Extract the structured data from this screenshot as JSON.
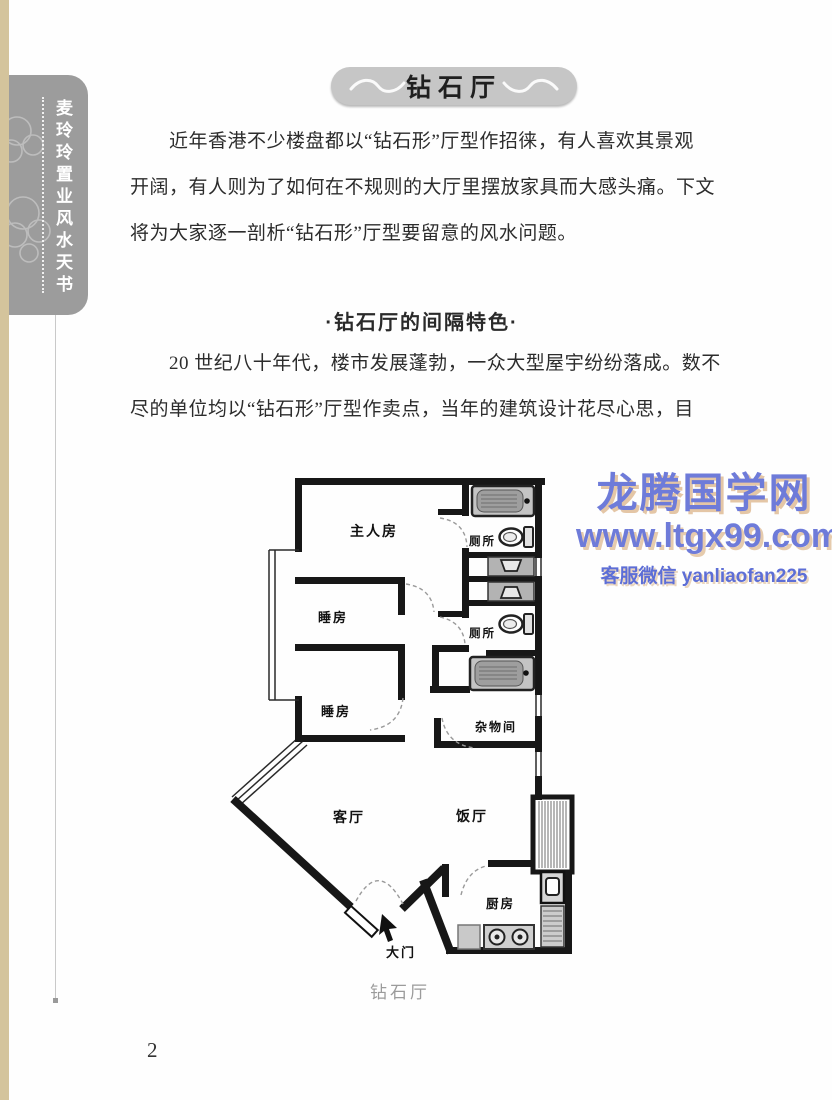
{
  "sidebar": {
    "book_title": "麦玲玲置业风水天书"
  },
  "title_banner": {
    "text": "钻石厅"
  },
  "article": {
    "para1_lines": [
      "近年香港不少楼盘都以“钻石形”厅型作招徕，有人喜欢其景观",
      "开阔，有人则为了如何在不规则的大厅里摆放家具而大感头痛。下文",
      "将为大家逐一剖析“钻石形”厅型要留意的风水问题。"
    ],
    "section_heading": "·钻石厅的间隔特色·",
    "para2_lines": [
      "20 世纪八十年代，楼市发展蓬勃，一众大型屋宇纷纷落成。数不",
      "尽的单位均以“钻石形”厅型作卖点，当年的建筑设计花尽心思，目"
    ]
  },
  "watermark": {
    "site_name": "龙腾国学网",
    "url": "www.ltgx99.com",
    "contact": "客服微信 yanliaofan225",
    "text_color": "#6e7bd9",
    "shadow_color": "#d9b38c"
  },
  "floorplan": {
    "caption": "钻石厅",
    "rooms": {
      "master_bedroom": "主人房",
      "toilet_upper": "厕所",
      "toilet_lower": "厕所",
      "bedroom_1": "睡房",
      "bedroom_2": "睡房",
      "storage_room": "杂物间",
      "living_room": "客厅",
      "dining_room": "饭厅",
      "kitchen": "厨房",
      "main_door": "大门"
    },
    "fixtures": [
      "bathtub",
      "toilet",
      "washbasin",
      "stove",
      "sink",
      "fridge",
      "bay-window",
      "entry-arrow"
    ]
  },
  "page_number": "2"
}
